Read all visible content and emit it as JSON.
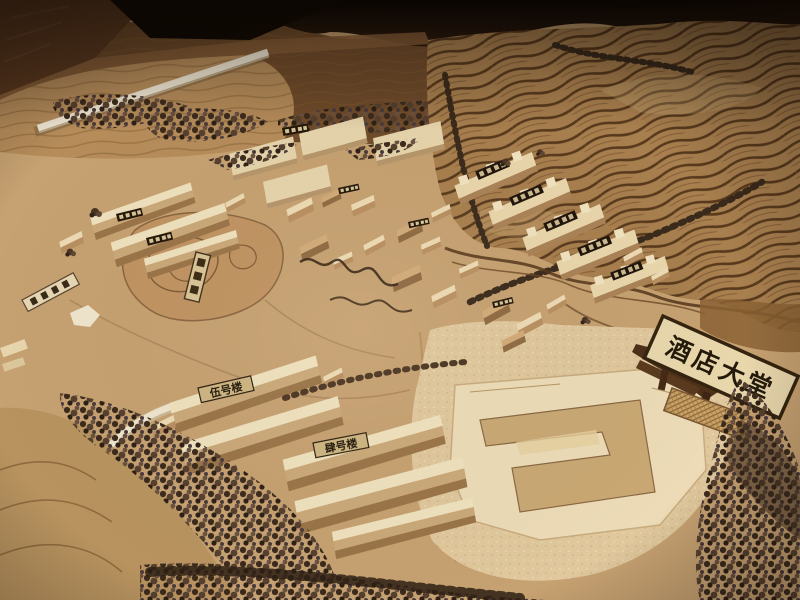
{
  "meta": {
    "kind": "photograph",
    "subject": "Wooden architectural scale model of a hillside resort complex on a dark display table"
  },
  "signs": {
    "hotel_lobby": "酒店大堂",
    "building_no_5": "伍号楼",
    "building_no_4": "肆号楼"
  },
  "scene": {
    "elements": [
      "laser-carved terraced hillside with contour stripes",
      "clusters of small gabled wooden buildings with roof plaques (characters too small to read)",
      "rows of notched townhouse blocks with dark name plaques",
      "engraved lake garden with islands and a small standing sign",
      "large hotel-lobby footprint board with U-shaped wall on a speckled plaza",
      "white elevated roadway across the far hills",
      "diagonal bands and rows of model trees",
      "tilted wooden gateway holding the hotel lobby sign",
      "small fallen plank sign at left edge"
    ]
  },
  "palette": {
    "table_wood": "#5c3a20",
    "deep_shadow": "#0f0803",
    "far_hills": "#6f4b2a",
    "terraced_hill": "#a87f4e",
    "contour_line": "#4a2d13",
    "plain": "#c6a171",
    "plaza": "#e0c79c",
    "building_light": "#efe1bd",
    "building_side": "#b28c5e",
    "foliage": "#3c2b1d",
    "plaque_bg": "#e9d7ac",
    "plaque_border": "#34240f",
    "ink": "#241a0c"
  }
}
